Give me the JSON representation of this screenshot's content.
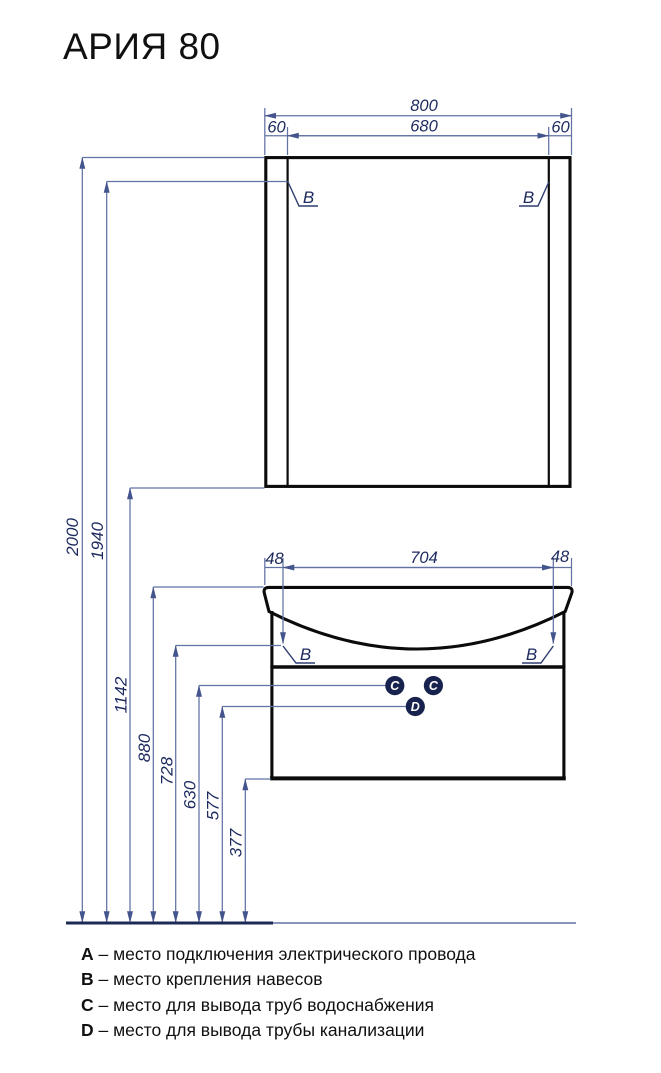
{
  "title": "АРИЯ 80",
  "drawing": {
    "mirror": {
      "width_total": "800",
      "width_inner": "680",
      "offset_left": "60",
      "offset_right": "60",
      "mount_left": "B",
      "mount_right": "B"
    },
    "cabinet": {
      "offset_left": "48",
      "width_center": "704",
      "offset_right": "48",
      "mount_left": "B",
      "mount_right": "B",
      "water_outlet_1": "C",
      "water_outlet_2": "C",
      "drain_outlet": "D"
    },
    "heights": [
      "2000",
      "1940",
      "1142",
      "880",
      "728",
      "630",
      "577",
      "377"
    ]
  },
  "legend": {
    "items": [
      {
        "letter": "A",
        "desc": "– место подключения электрического провода"
      },
      {
        "letter": "B",
        "desc": "– место крепления навесов"
      },
      {
        "letter": "C",
        "desc": "– место для вывода труб водоснабжения"
      },
      {
        "letter": "D",
        "desc": "– место для вывода трубы канализации"
      }
    ]
  },
  "colors": {
    "dimension_line": "#6272a3",
    "dimension_text": "#1d2a5e",
    "marker_fill": "#18224e",
    "ink": "#0b0b0b"
  }
}
